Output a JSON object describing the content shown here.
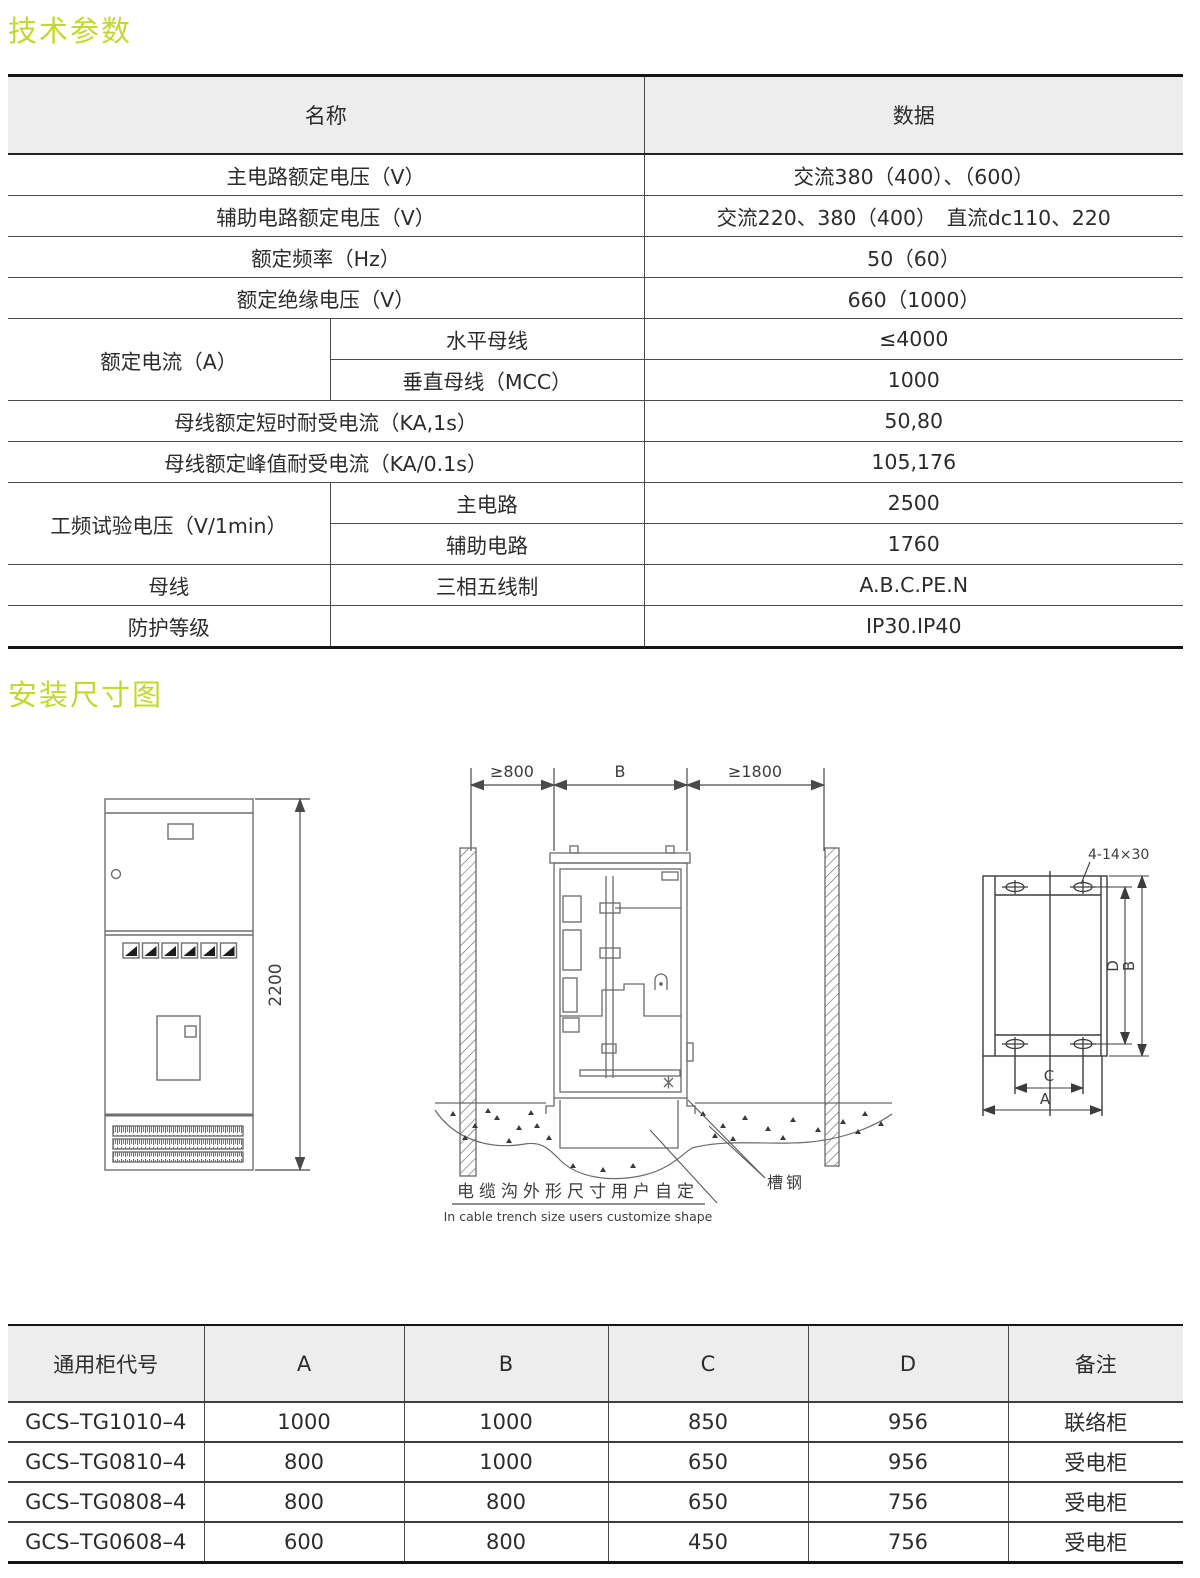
{
  "sections": {
    "tech_params_title": "技术参数",
    "install_dims_title": "安装尺寸图"
  },
  "accent_color": "#c2d82d",
  "spec_table": {
    "header": {
      "name": "名称",
      "data": "数据"
    },
    "rows": [
      {
        "name": "主电路额定电压（V）",
        "value": "交流380（400）、（600）"
      },
      {
        "name": "辅助电路额定电压（V）",
        "value": "交流220、380（400）　直流dc110、220"
      },
      {
        "name": "额定频率（Hz）",
        "value": "50（60）"
      },
      {
        "name": "额定绝缘电压（V）",
        "value": "660（1000）"
      },
      {
        "group": "额定电流（A）",
        "sub": "水平母线",
        "value": "≤4000"
      },
      {
        "sub": "垂直母线（MCC）",
        "value": "1000"
      },
      {
        "name": "母线额定短时耐受电流（KA,1s）",
        "value": "50,80"
      },
      {
        "name": "母线额定峰值耐受电流（KA/0.1s）",
        "value": "105,176"
      },
      {
        "group": "工频试验电压（V/1min）",
        "sub": "主电路",
        "value": "2500"
      },
      {
        "sub": "辅助电路",
        "value": "1760"
      },
      {
        "name": "母线",
        "sub": "三相五线制",
        "value": "A.B.C.PE.N"
      },
      {
        "name": "防护等级",
        "sub": "",
        "value": "IP30.IP40"
      }
    ]
  },
  "diagram": {
    "front_view": {
      "height_label": "2200"
    },
    "trench_view": {
      "left_clearance": "≥800",
      "width_label": "B",
      "right_clearance": "≥1800",
      "channel_steel_label": "槽钢",
      "caption_cn": "电缆沟外形尺寸用户自定",
      "caption_en": "In cable trench size users customize shape"
    },
    "plan_view": {
      "holes_label": "4-14×30",
      "dim_d": "D",
      "dim_b": "B",
      "dim_c": "C",
      "dim_a": "A"
    }
  },
  "dim_table": {
    "headers": [
      "通用柜代号",
      "A",
      "B",
      "C",
      "D",
      "备注"
    ],
    "rows": [
      [
        "GCS–TG1010–4",
        "1000",
        "1000",
        "850",
        "956",
        "联络柜"
      ],
      [
        "GCS–TG0810–4",
        "800",
        "1000",
        "650",
        "956",
        "受电柜"
      ],
      [
        "GCS–TG0808–4",
        "800",
        "800",
        "650",
        "756",
        "受电柜"
      ],
      [
        "GCS–TG0608–4",
        "600",
        "800",
        "450",
        "756",
        "受电柜"
      ]
    ]
  }
}
